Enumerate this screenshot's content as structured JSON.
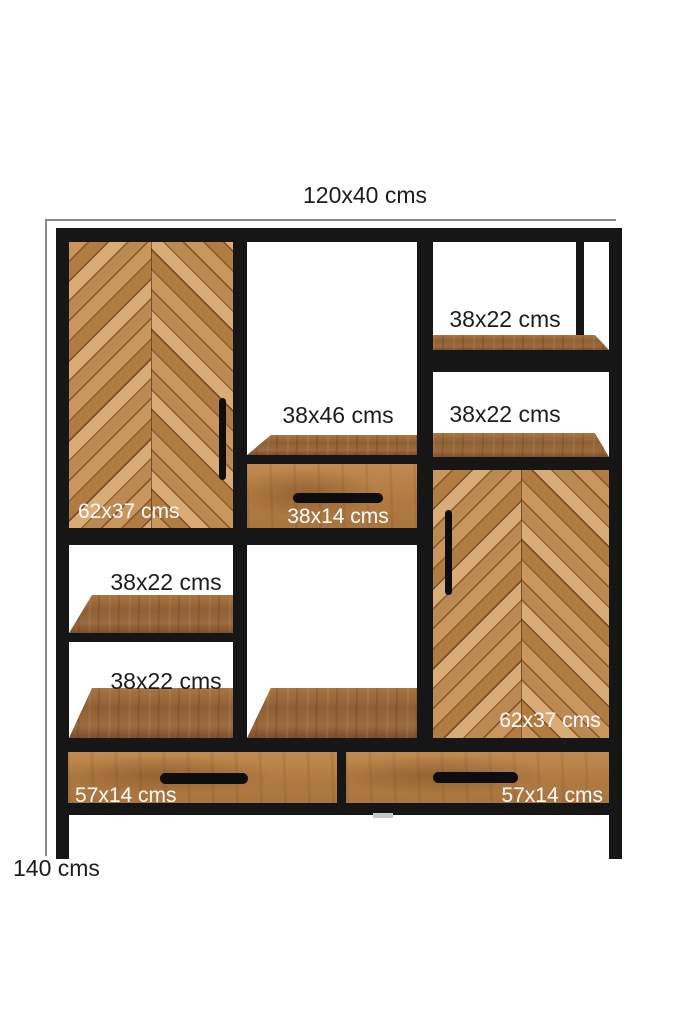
{
  "dimensions": {
    "width_depth": "120x40 cms",
    "height": "140 cms"
  },
  "compartment_labels": {
    "right_shelf_top": "38x22 cms",
    "right_shelf_middle": "38x22 cms",
    "center_open": "38x46 cms",
    "left_door": "62x37 cms",
    "center_drawer": "38x14 cms",
    "left_shelf_upper": "38x22 cms",
    "left_shelf_lower": "38x22 cms",
    "right_door": "62x37 cms",
    "bottom_drawer_left": "57x14 cms",
    "bottom_drawer_right": "57x14 cms"
  },
  "colors": {
    "frame": "#161616",
    "dimension_line": "#8a8a8a",
    "label_dark": "#1c1c1c",
    "label_light": "#ffffff",
    "wood_light": "#c9965e",
    "wood_mid": "#a9753f",
    "wood_dark": "#8a5a36"
  }
}
